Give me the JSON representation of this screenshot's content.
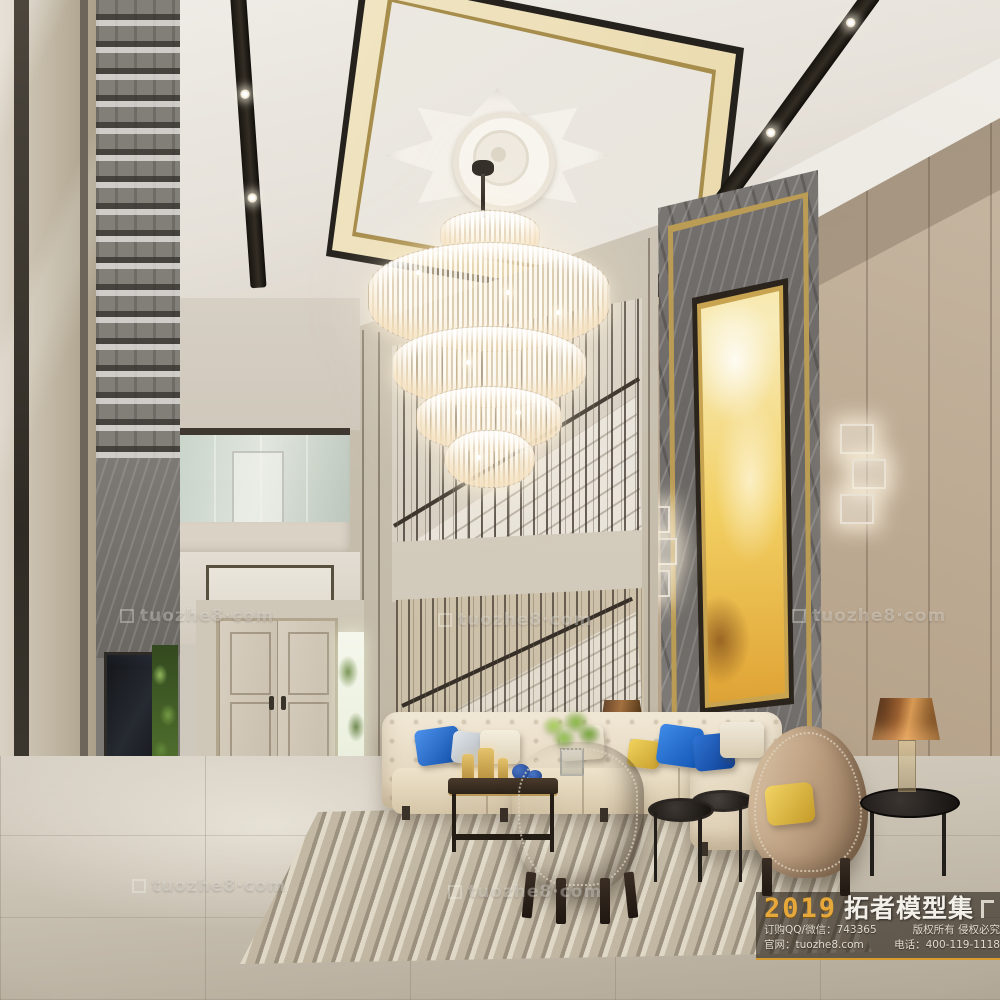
{
  "watermark": {
    "text": "tuozhe8·com"
  },
  "banner": {
    "year": "2019",
    "brand": "拓者模型集",
    "order_line": "订购QQ/微信：743365",
    "rights_line": "版权所有 侵权必究",
    "site_line": "官网：tuozhe8.com",
    "phone_line": "电话：400-119-1118"
  },
  "palette": {
    "ceiling_band_cream": "#ead9ab",
    "ceiling_gold_trim": "#a78d4c",
    "wall_greige": "#bba890",
    "marble_gray": "#6f6b68",
    "artwork_gold": "#e8bc42",
    "sofa_cream": "#ecdfc6",
    "pillow_blue": "#1256b4",
    "pillow_yellow": "#e6c24a",
    "armchair_taupe": "#7d6353",
    "lamp_copper": "#9a5f30",
    "floor_warm_gray": "#c6beb0",
    "banner_yellow": "#e6a83a",
    "banner_background": "rgba(38,30,22,0.6)"
  }
}
